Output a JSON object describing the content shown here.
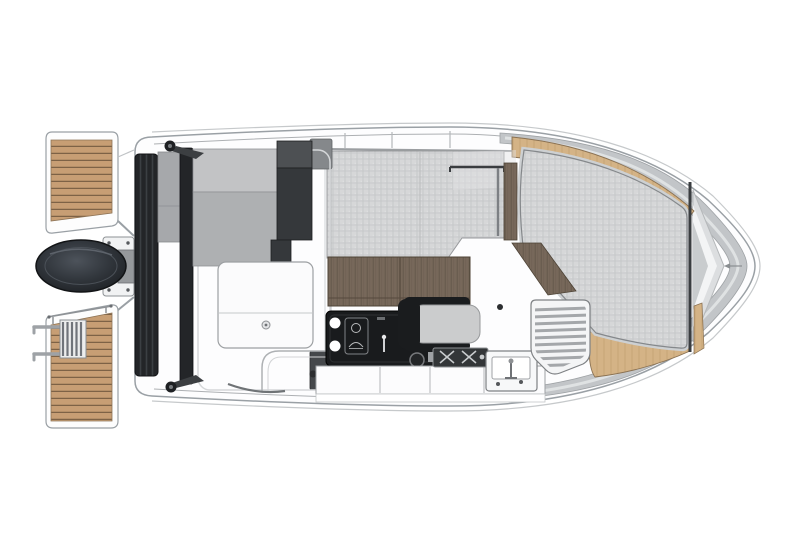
{
  "meta": {
    "title": "Motor boat deck plan — top view illustration",
    "type": "technical floor-plan drawing, no text labels",
    "canvas": {
      "width": 800,
      "height": 533
    },
    "orientation": "bow to the right, stern (swim platforms and outboard engine) to the left"
  },
  "colors": {
    "paper": "#ffffff",
    "hull_fill": "#fdfdfe",
    "hull_stroke": "#9aa0a5",
    "rim_line": "#c6c9cb",
    "metal_band": "#c2c5c8",
    "metal_streak": "#e2e4e5",
    "mat_base": "#d6d7d8",
    "mat_grid": "#c4c5c7",
    "teak_base": "#c79e74",
    "teak_line": "#7d6246",
    "tan_trim": "#d4b386",
    "walnut_base": "#77685a",
    "walnut_grain": "#5b4f43",
    "dark_1": "#232528",
    "dark_2": "#3c3f42",
    "bench_light": "#c2c3c5",
    "bench_mid": "#aeb0b2",
    "white_part": "#f9fafb",
    "outline": "#7e8184",
    "soft_outline": "#adb0b3",
    "engine_dark": "#1f2226",
    "engine_mid": "#4d535b"
  },
  "components": [
    {
      "id": "hull",
      "label": "hull with rounded bow and squared transom"
    },
    {
      "id": "gunwale-band",
      "label": "metallic gray gunwale band around bow"
    },
    {
      "id": "swim-platform-top",
      "label": "teak swim platform, port stern"
    },
    {
      "id": "swim-platform-bottom",
      "label": "teak swim platform, starboard stern"
    },
    {
      "id": "boarding-ladder",
      "label": "folded boarding ladder with rails"
    },
    {
      "id": "stern-rail",
      "label": "platform grab rail"
    },
    {
      "id": "outboard-engine",
      "label": "outboard engine cowling on transom bracket"
    },
    {
      "id": "transom-bench",
      "label": "aft cockpit bench with dark backrest rails"
    },
    {
      "id": "cockpit-table",
      "label": "white cockpit table with latch fitting"
    },
    {
      "id": "cabin-floor",
      "label": "walnut cabin sole panels"
    },
    {
      "id": "roof-mat",
      "label": "textured canvas wheelhouse roof"
    },
    {
      "id": "grab-rail",
      "label": "roof grab rail"
    },
    {
      "id": "galley-console",
      "label": "black galley console with sink cupholders and stove"
    },
    {
      "id": "helm-seat",
      "label": "pilot seat facing bow"
    },
    {
      "id": "grill",
      "label": "twin-burner stove top with pot holders"
    },
    {
      "id": "wet-bar-sink",
      "label": "small sink box with faucet"
    },
    {
      "id": "louvered-hatch",
      "label": "louvered vent hatch panel"
    },
    {
      "id": "companionway-steps",
      "label": "walnut step stripe to foredeck"
    },
    {
      "id": "bow-sunpad",
      "label": "large textured bow sunpad"
    },
    {
      "id": "caprail",
      "label": "tan wood caprail trim along bow gunwales"
    },
    {
      "id": "bow-divider-line",
      "label": "dark athwartship deck seam at foredeck"
    },
    {
      "id": "anchor-chevron",
      "label": "concentric chevrons at anchor locker"
    },
    {
      "id": "cleats",
      "label": "mooring cleats on transom corners"
    }
  ]
}
